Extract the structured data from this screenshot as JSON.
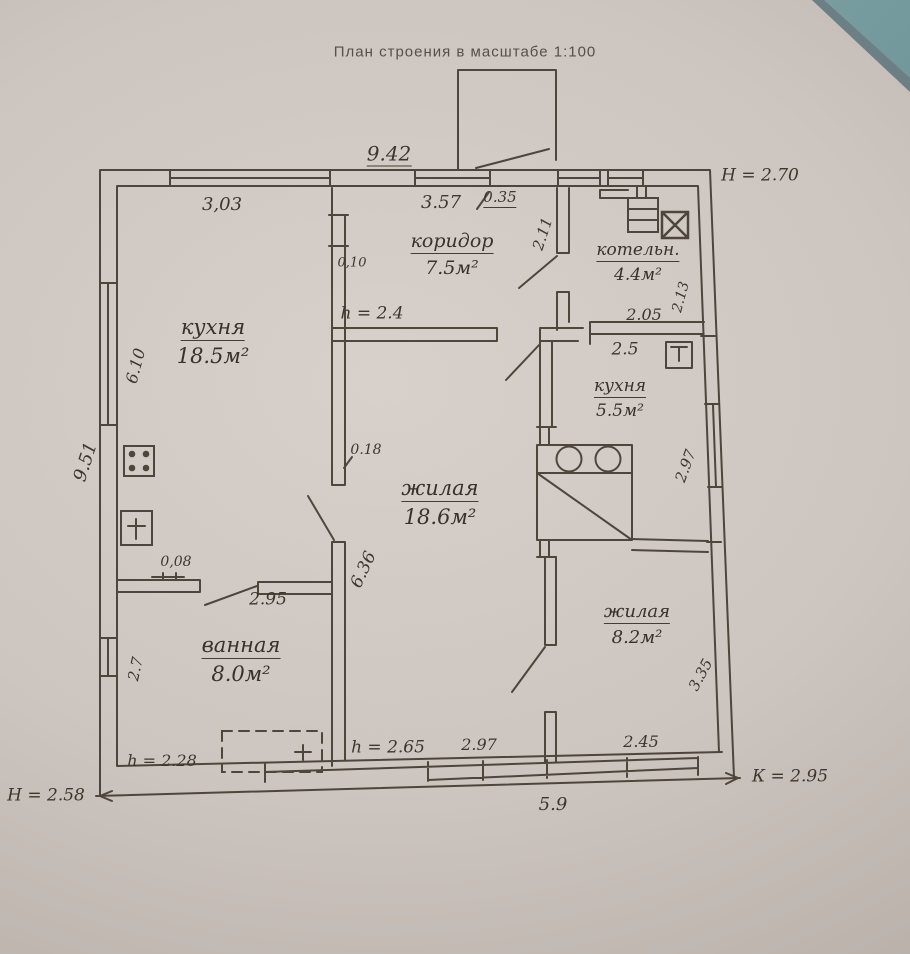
{
  "title": "План строения в масштабе 1:100",
  "rooms": {
    "corridor": {
      "name": "коридор",
      "area": "7.5м²"
    },
    "boiler": {
      "name": "котельн.",
      "area": "4.4м²"
    },
    "kitchen_big": {
      "name": "кухня",
      "area": "18.5м²"
    },
    "kitchen_small": {
      "name": "кухня",
      "area": "5.5м²"
    },
    "living_big": {
      "name": "жилая",
      "area": "18.6м²"
    },
    "living_small": {
      "name": "жилая",
      "area": "8.2м²"
    },
    "bath": {
      "name": "ванная",
      "area": "8.0м²"
    }
  },
  "heights": {
    "outer_top_right": "Н = 2.70",
    "corridor": "h = 2.4",
    "bath": "h = 2.28",
    "living": "h = 2.65",
    "outer_bottom_left": "Н = 2.58",
    "outer_bottom_right": "К = 2.95"
  },
  "dimensions": {
    "top_total": "9.42",
    "top_left_window": "3,03",
    "top_right_window": "3.57",
    "top_small": "0.35",
    "boiler_left": "2.11",
    "boiler_width": "2.05",
    "boiler_right": "2.13",
    "kitchen_small_top": "2.5",
    "kitchen_small_right": "2.97",
    "corridor_stub": "0,10",
    "kitchen_big_left": "6.10",
    "left_total": "9.51",
    "wall_thickness": "0.18",
    "living_big_left": "6.36",
    "bath_stub": "0,08",
    "bath_door": "2.95",
    "bath_left": "2.7",
    "living_small_right": "3.35",
    "bottom_mid": "2.97",
    "bottom_right_window": "2.45",
    "bottom_total": "5.9"
  },
  "colors": {
    "ink": "#453c32",
    "paper": "#cdc5bf",
    "table": "#6f969a"
  }
}
